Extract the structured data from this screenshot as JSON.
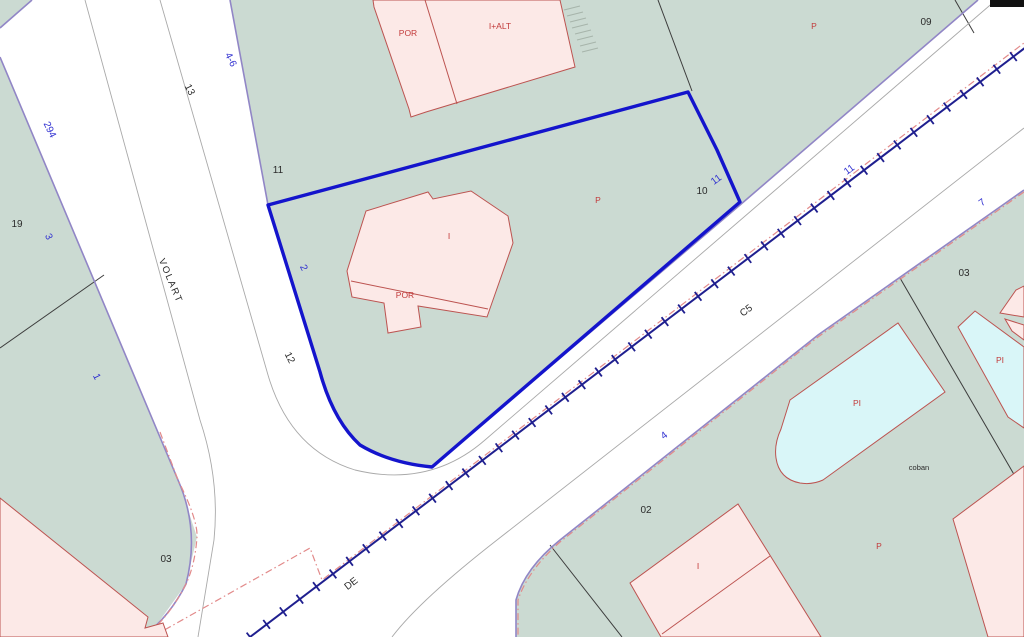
{
  "map_title": "Cadastral map viewer",
  "palette": {
    "parcel_green": "#cbdad2",
    "street_white": "#ffffff",
    "building_pink": "#fce9e7",
    "building_outline_red": "#bc5350",
    "pool_cyan": "#d9f6f8",
    "street_edge_purple": "#9186c6",
    "selected_parcel_blue": "#1414cc",
    "railway_navy": "#1f1f8f",
    "boundary_dash_red": "#e28a8a",
    "label_blue": "#2f2fd0",
    "label_black": "#2b2b2b",
    "label_red": "#c23a3a"
  },
  "railway": {
    "x1": 1030,
    "y1": 44,
    "x2": 250,
    "y2": 637,
    "tick_count": 48,
    "tick_len": 11
  },
  "labels": [
    {
      "text": "294"
    },
    {
      "text": "19"
    },
    {
      "text": "3"
    },
    {
      "text": "1"
    },
    {
      "text": "13"
    },
    {
      "text": "4-6"
    },
    {
      "text": "VOLART"
    },
    {
      "text": "11"
    },
    {
      "text": "2"
    },
    {
      "text": "12"
    },
    {
      "text": "03"
    },
    {
      "text": "POR"
    },
    {
      "text": "I+ALT"
    },
    {
      "text": "I"
    },
    {
      "text": "POR"
    },
    {
      "text": "P"
    },
    {
      "text": "10"
    },
    {
      "text": "11"
    },
    {
      "text": "P"
    },
    {
      "text": "09"
    },
    {
      "text": "11"
    },
    {
      "text": "C5"
    },
    {
      "text": "4"
    },
    {
      "text": "7"
    },
    {
      "text": "03"
    },
    {
      "text": "PI"
    },
    {
      "text": "PI"
    },
    {
      "text": "coban"
    },
    {
      "text": "02"
    },
    {
      "text": "I"
    },
    {
      "text": "P"
    },
    {
      "text": "DE"
    }
  ]
}
